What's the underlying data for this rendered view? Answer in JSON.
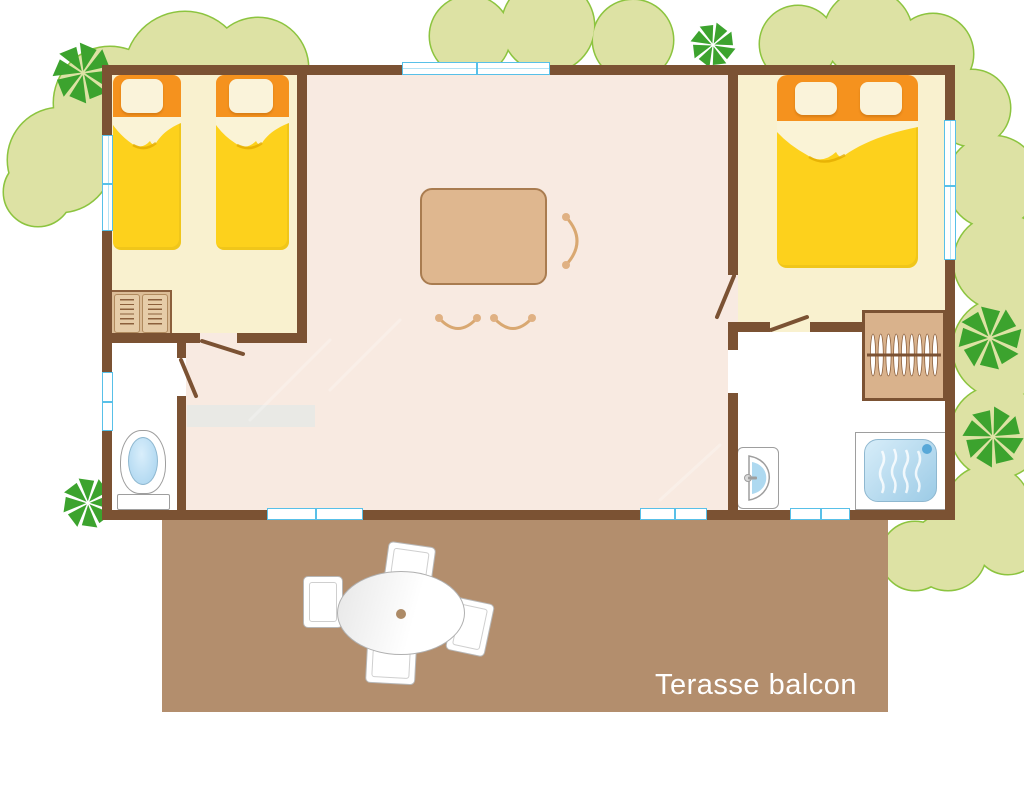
{
  "terrace": {
    "label": "Terasse balcon"
  },
  "palette": {
    "wall": "#7b5233",
    "terrace": "#b38e6d",
    "living_floor": "#f8eae1",
    "bedroom_floor": "#f9f1cf",
    "wet_room_floor": "#ffffff",
    "sofa_orange": "#f08c05",
    "bed_headboard_orange": "#f5921e",
    "bed_blanket_yellow": "#fdd11c",
    "pillow_cream": "#faf3da",
    "wood_tan": "#dcbd97",
    "wood_border": "#aa8057",
    "window_blue": "#58c0e8",
    "water_blue": "#a9d8ef",
    "tree_light": "#dde2a4",
    "tree_outline": "#8cc43f",
    "tree_dark": "#3ca32e",
    "label_text": "#ffffff"
  },
  "icons": [
    "single-bed",
    "double-bed",
    "corner-sofa",
    "dining-table",
    "dining-chair",
    "wardrobe-shelves",
    "wardrobe-hangers",
    "kitchen-sink",
    "gas-stove",
    "toilet",
    "washbasin",
    "shower",
    "window",
    "door-swing",
    "terrace-table",
    "terrace-chair",
    "tree",
    "palm-tree"
  ]
}
